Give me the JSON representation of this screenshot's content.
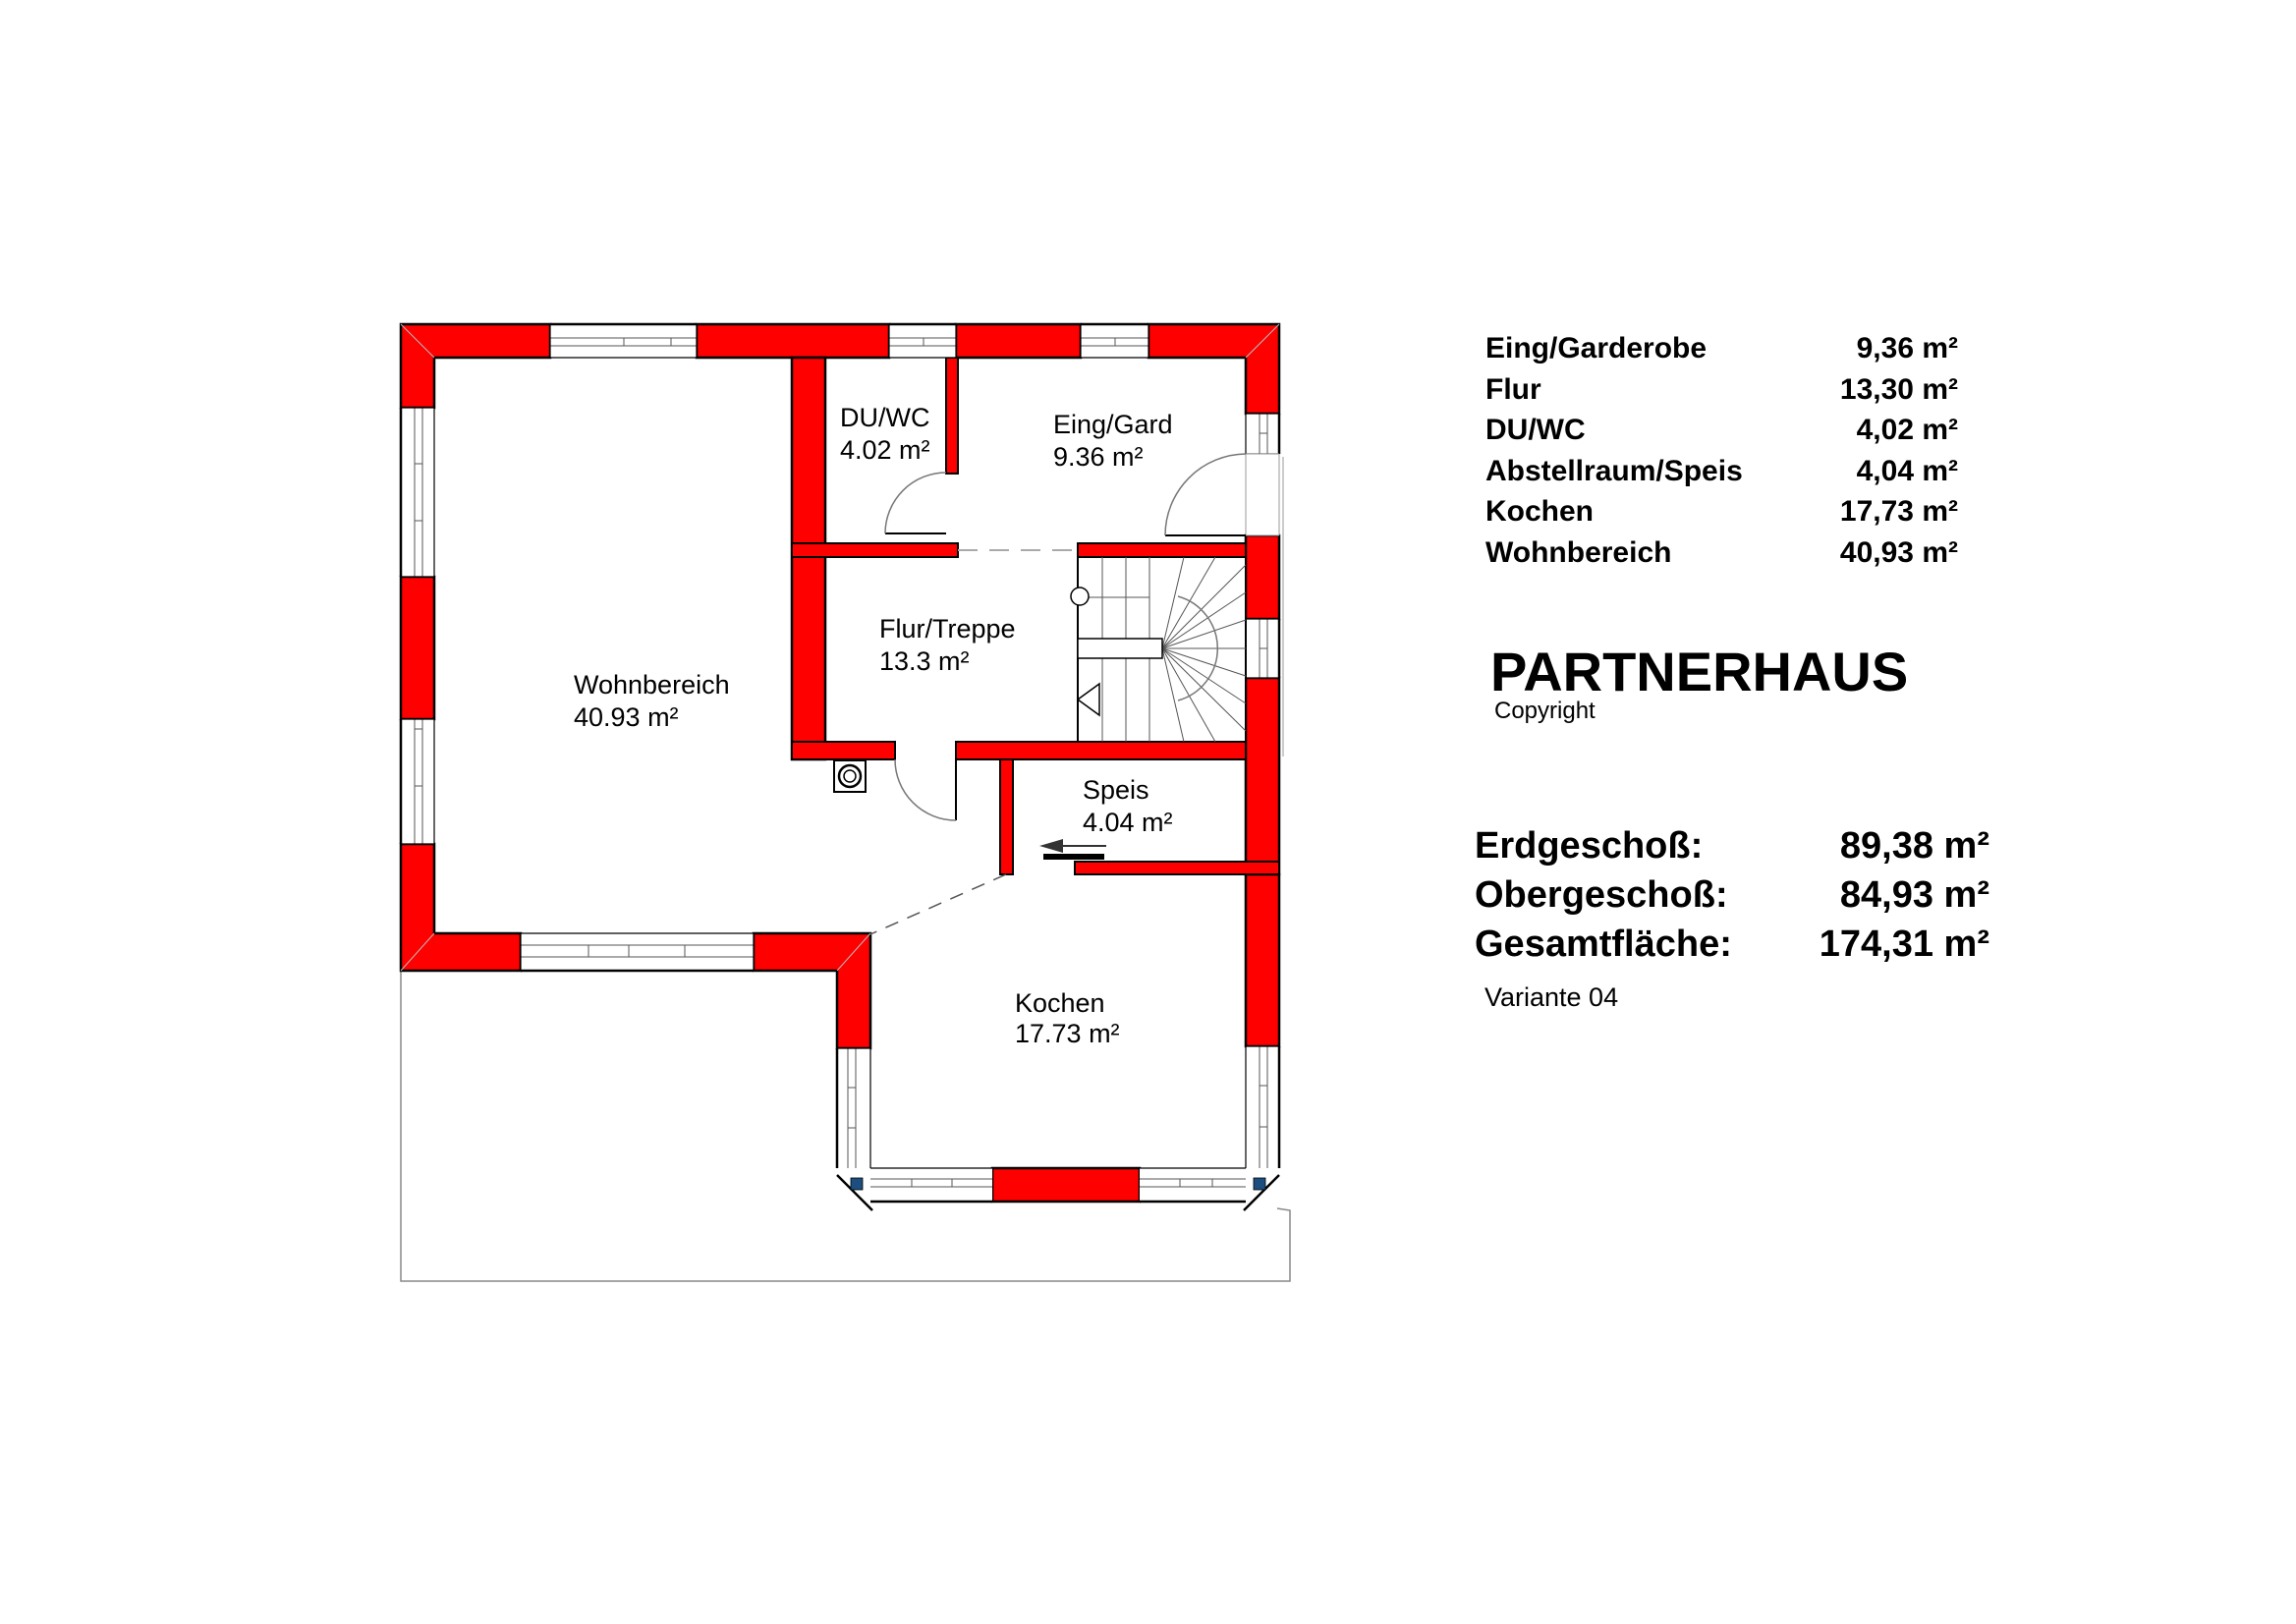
{
  "plan": {
    "rooms": [
      {
        "id": "wohnbereich",
        "name": "Wohnbereich",
        "area": "40.93 m²"
      },
      {
        "id": "duwc",
        "name": "DU/WC",
        "area": "4.02 m²"
      },
      {
        "id": "eing",
        "name": "Eing/Gard",
        "area": "9.36 m²"
      },
      {
        "id": "flur",
        "name": "Flur/Treppe",
        "area": "13.3 m²"
      },
      {
        "id": "speis",
        "name": "Speis",
        "area": "4.04 m²"
      },
      {
        "id": "kochen",
        "name": "Kochen",
        "area": "17.73 m²"
      }
    ]
  },
  "legend": {
    "rows": [
      {
        "label": "Eing/Garderobe",
        "value": "9,36 m²"
      },
      {
        "label": "Flur",
        "value": "13,30 m²"
      },
      {
        "label": "DU/WC",
        "value": "4,02 m²"
      },
      {
        "label": "Abstellraum/Speis",
        "value": "4,04 m²"
      },
      {
        "label": "Kochen",
        "value": "17,73 m²"
      },
      {
        "label": "Wohnbereich",
        "value": "40,93 m²"
      }
    ]
  },
  "title": {
    "name": "PARTNERHAUS",
    "copyright": "Copyright"
  },
  "summary": {
    "rows": [
      {
        "label": "Erdgeschoß:",
        "value": "89,38 m²"
      },
      {
        "label": "Obergeschoß:",
        "value": "84,93 m²"
      },
      {
        "label": "Gesamtfläche:",
        "value": "174,31 m²"
      }
    ],
    "variant": "Variante 04"
  },
  "colors": {
    "wall": "#ff0000",
    "outline": "#000000",
    "window_line": "#555555",
    "terrace_line": "#888888",
    "corner_post": "#1c4f7f"
  }
}
